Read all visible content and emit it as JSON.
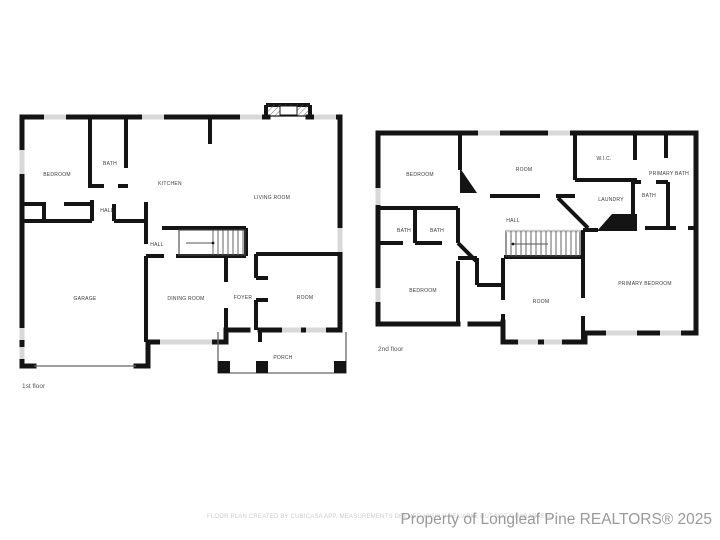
{
  "floors": [
    {
      "label": "1st floor",
      "rooms": [
        "BEDROOM",
        "BATH",
        "KITCHEN",
        "LIVING ROOM",
        "HALL",
        "HALL",
        "GARAGE",
        "DINING ROOM",
        "FOYER",
        "ROOM",
        "PORCH"
      ]
    },
    {
      "label": "2nd floor",
      "rooms": [
        "BEDROOM",
        "ROOM",
        "W.I.C.",
        "PRIMARY BATH",
        "LAUNDRY",
        "BATH",
        "BATH",
        "BATH",
        "HALL",
        "BEDROOM",
        "ROOM",
        "PRIMARY BEDROOM"
      ]
    }
  ],
  "footer": {
    "disclaimer": "FLOOR PLAN CREATED BY CUBICASA APP. MEASUREMENTS DEEMED HIGHLY RELIABLE BUT NOT GUARANTEED",
    "watermark": "Property of Longleaf Pine REALTORS® 2025"
  },
  "colors": {
    "wall": "#141414",
    "window": "#d8d8d8",
    "room_label": "#3a3a3a",
    "disclaimer_gray": "#cccccc",
    "watermark_gray": "#999999"
  }
}
